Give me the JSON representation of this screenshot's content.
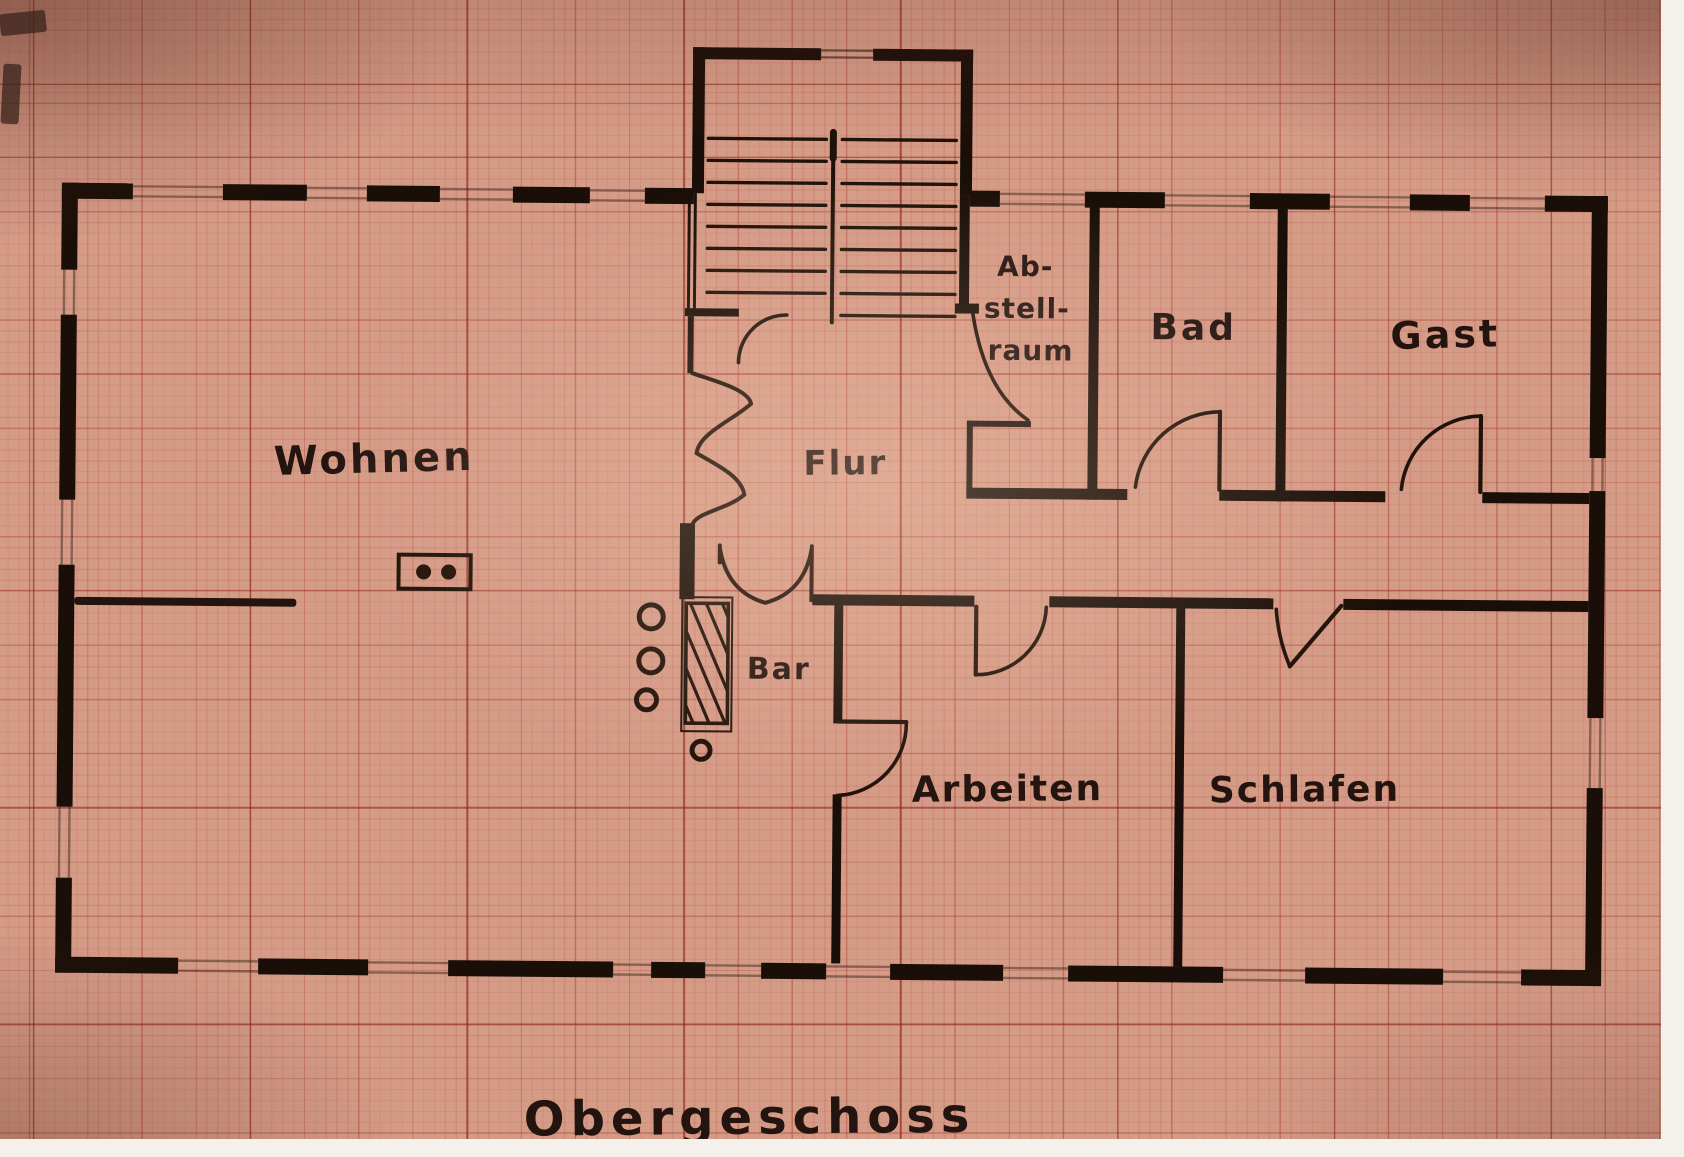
{
  "palette": {
    "paper": "#d49b87",
    "grid_major": "#8c2a20",
    "ink": "#241410",
    "photo_border": "#f4f1ec"
  },
  "floor_plan": {
    "title": "Obergeschoss",
    "rooms": {
      "wohnen": "Wohnen",
      "flur": "Flur",
      "abstellraum_lines": [
        "Ab-",
        "stell-",
        "raum"
      ],
      "bad": "Bad",
      "gast": "Gast",
      "bar": "Bar",
      "arbeiten": "Arbeiten",
      "schlafen": "Schlafen"
    }
  }
}
